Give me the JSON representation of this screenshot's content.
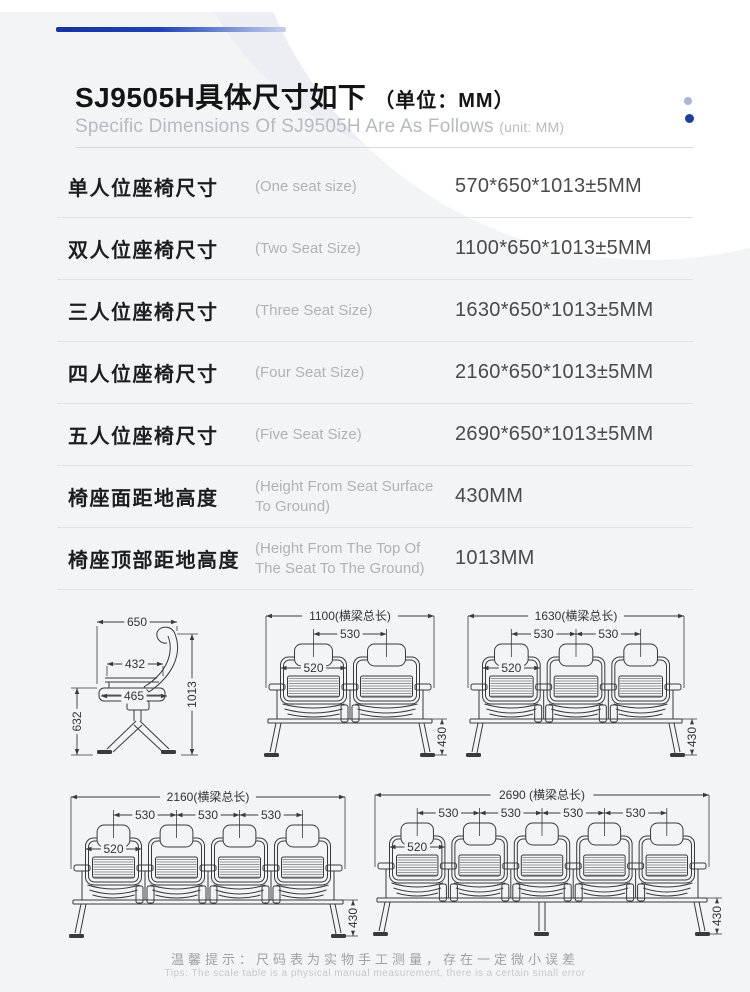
{
  "header": {
    "title_cn": "SJ9505H具体尺寸如下",
    "title_unit": "（单位：MM）",
    "subtitle_en": "Specific Dimensions Of SJ9505H Are As Follows",
    "subtitle_unit": "(unit: MM)"
  },
  "spec_table": {
    "rows": [
      {
        "label_cn": "单人位座椅尺寸",
        "label_en": "(One seat size)",
        "value": "570*650*1013±5MM"
      },
      {
        "label_cn": "双人位座椅尺寸",
        "label_en": "(Two Seat Size)",
        "value": "1100*650*1013±5MM"
      },
      {
        "label_cn": "三人位座椅尺寸",
        "label_en": "(Three Seat Size)",
        "value": "1630*650*1013±5MM"
      },
      {
        "label_cn": "四人位座椅尺寸",
        "label_en": "(Four Seat Size)",
        "value": "2160*650*1013±5MM"
      },
      {
        "label_cn": "五人位座椅尺寸",
        "label_en": "(Five Seat Size)",
        "value": "2690*650*1013±5MM"
      },
      {
        "label_cn": "椅座面距地高度",
        "label_en": "(Height From Seat Surface To Ground)",
        "value": "430MM"
      },
      {
        "label_cn": "椅座顶部距地高度",
        "label_en": "(Height From The Top Of The Seat To The Ground)",
        "value": "1013MM"
      }
    ]
  },
  "drawings": {
    "side": {
      "seats": 1,
      "depth": "650",
      "back_width": "432",
      "seat_depth": "465",
      "seat_front_height": "632",
      "total_height": "1013"
    },
    "fronts": [
      {
        "seats": 2,
        "overall": "1100(横梁总长)",
        "pitch": "530",
        "seat_width": "520",
        "leg_height": "430"
      },
      {
        "seats": 3,
        "overall": "1630(横梁总长)",
        "pitch": "530",
        "seat_width": "520",
        "leg_height": "430"
      },
      {
        "seats": 4,
        "overall": "2160(横梁总长)",
        "pitch": "530",
        "seat_width": "520",
        "leg_height": "430"
      },
      {
        "seats": 5,
        "overall": "2690 (横梁总长)",
        "pitch": "530",
        "seat_width": "520",
        "leg_height": "430"
      }
    ]
  },
  "footer": {
    "tip_cn": "温馨提示：尺码表为实物手工测量，存在一定微小误差",
    "tip_en": "Tips: The scale table is a physical manual measurement, there is a certain small error"
  },
  "colors": {
    "page_bg": "#f3f4f6",
    "accent_dark": "#16339e",
    "accent_light": "#c6d0ec",
    "dot_light": "#a9b5da",
    "dot_dark": "#1c3d9c",
    "drawing_line": "#3a3a3a",
    "dim_text": "#333333"
  }
}
